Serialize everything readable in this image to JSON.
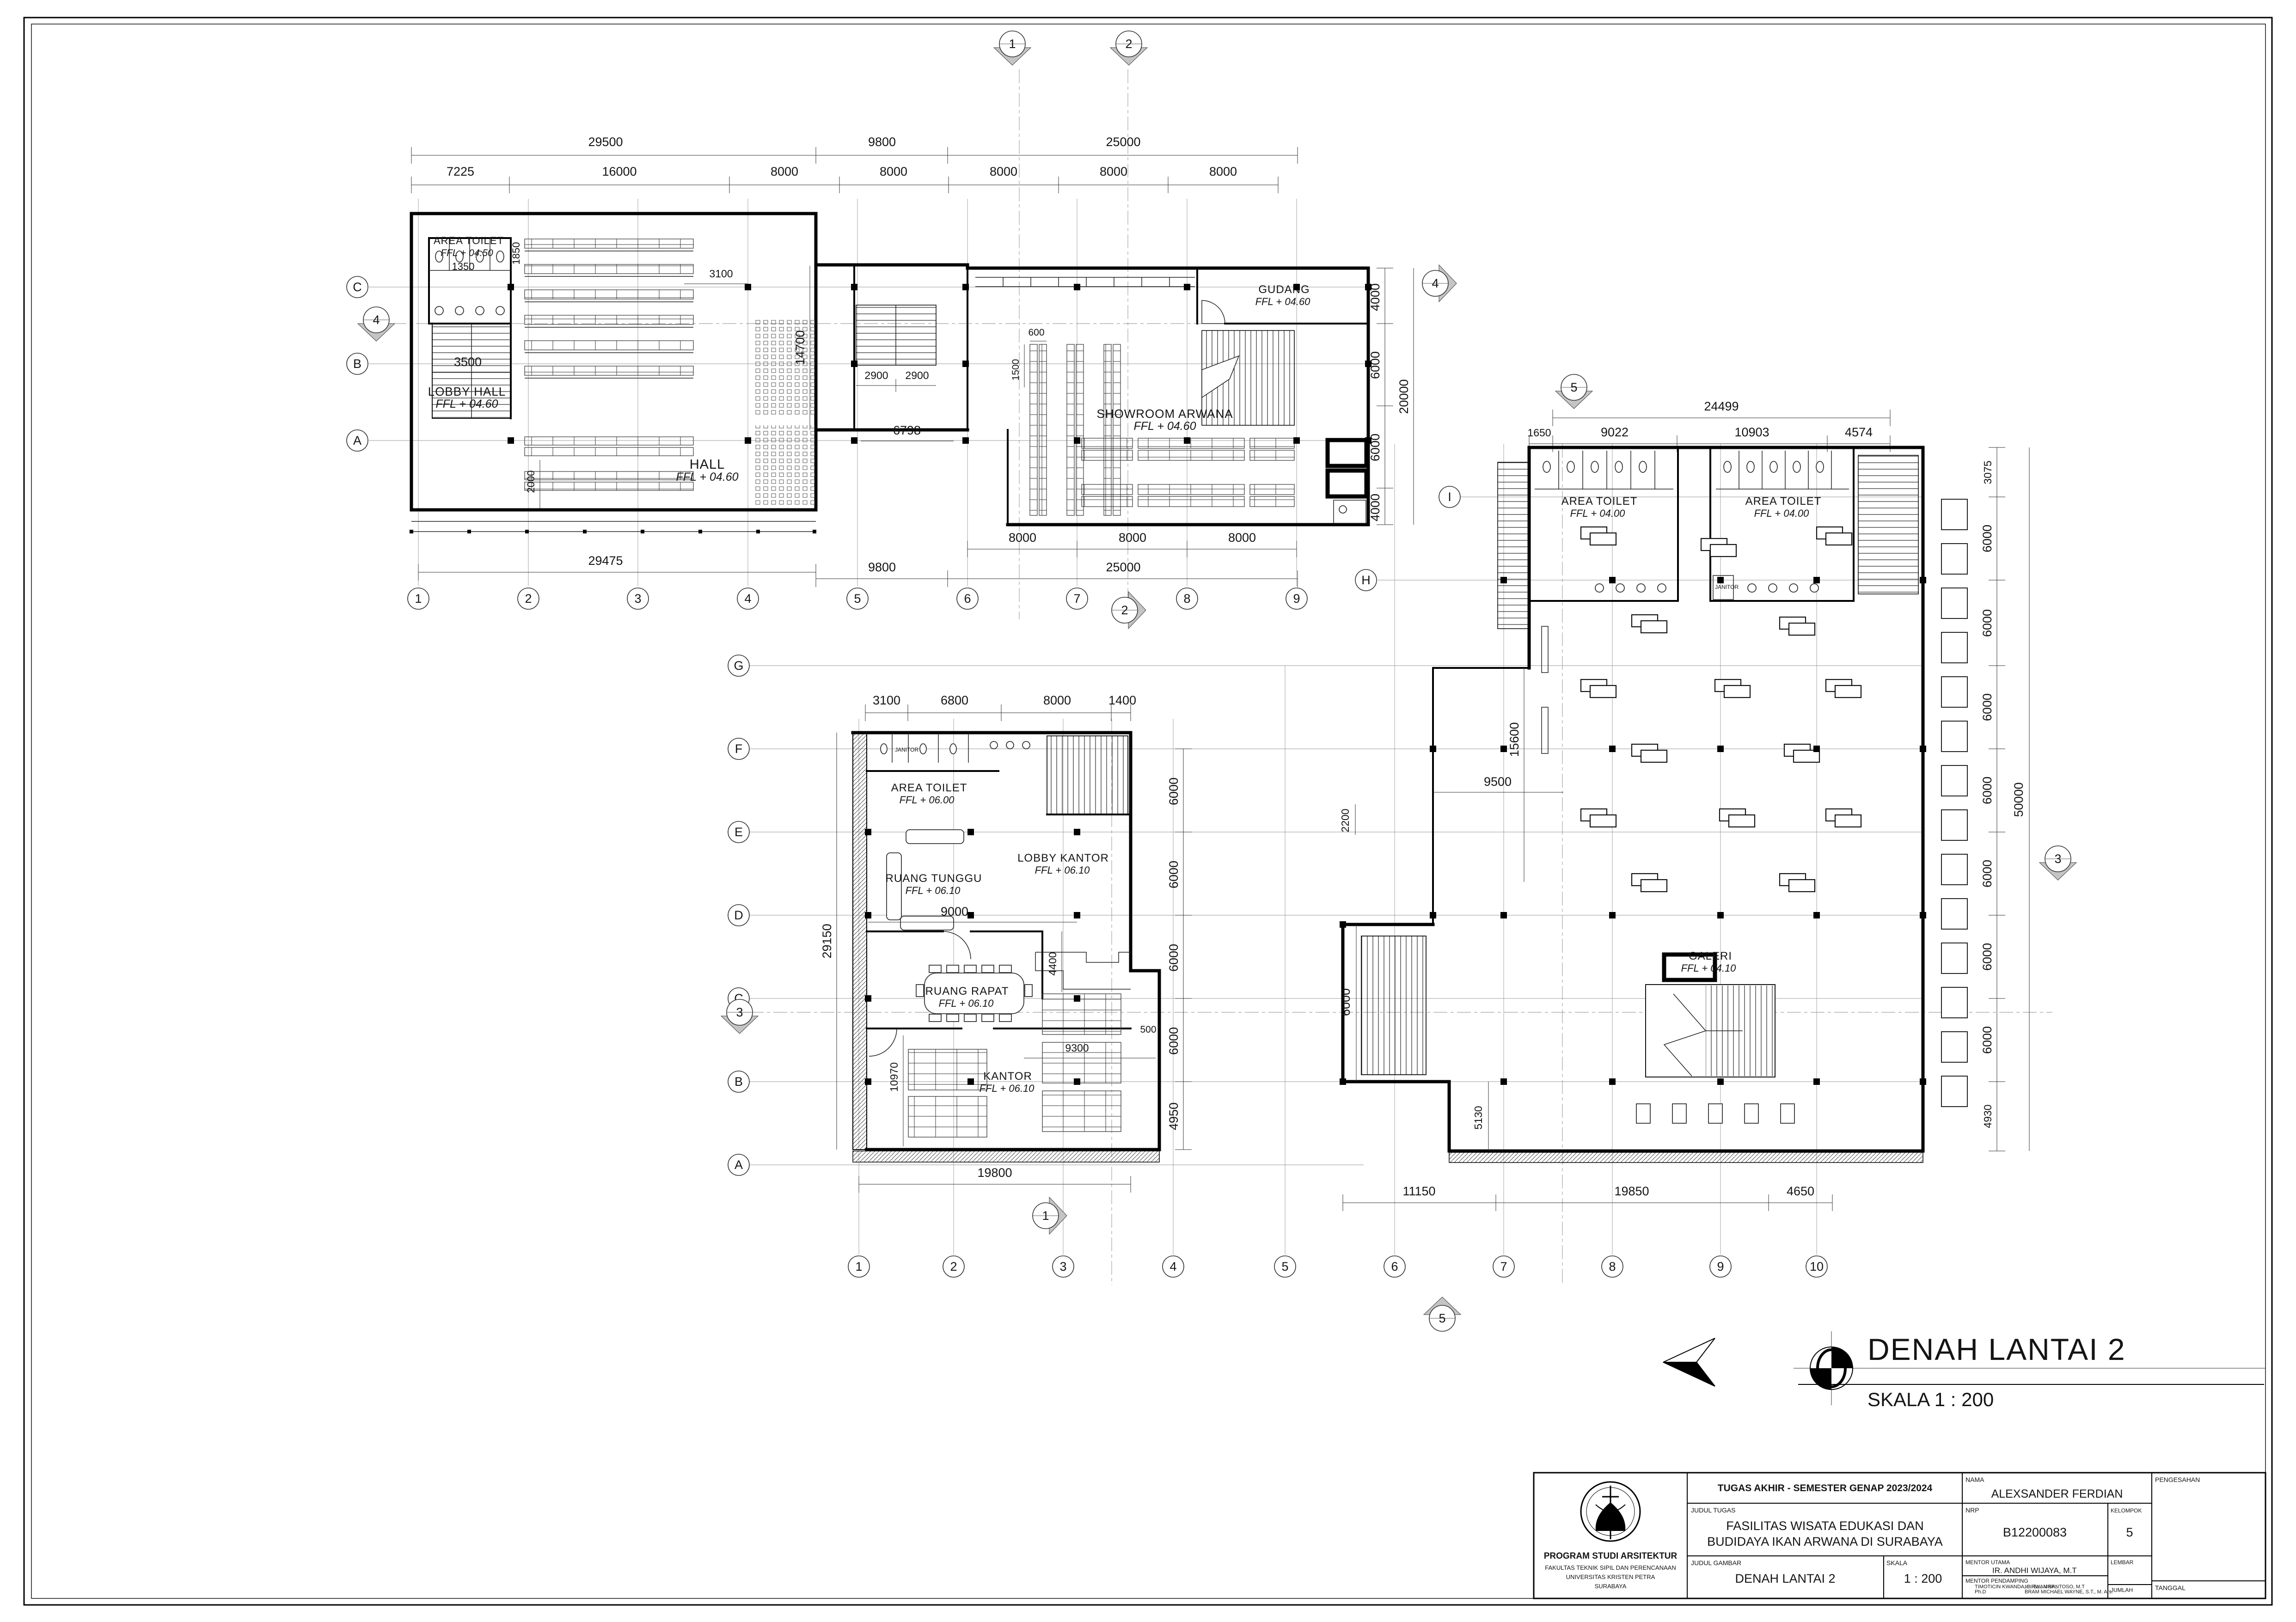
{
  "title": {
    "text": "DENAH LANTAI 2",
    "scale": "SKALA 1 : 200"
  },
  "rooms": {
    "hall": {
      "toilet": [
        "AREA TOILET",
        "FFL + 04.50"
      ],
      "lobby": [
        "LOBBY HALL",
        "FFL + 04.60"
      ],
      "hall": [
        "HALL",
        "FFL + 04.60"
      ]
    },
    "showroom": {
      "gudang": [
        "GUDANG",
        "FFL + 04.60"
      ],
      "showroom": [
        "SHOWROOM ARWANA",
        "FFL + 04.60"
      ]
    },
    "office": {
      "toilet": [
        "AREA TOILET",
        "FFL + 06.00"
      ],
      "janitor": "JANITOR",
      "tunggu": [
        "RUANG TUNGGU",
        "FFL + 06.10"
      ],
      "lobby": [
        "LOBBY KANTOR",
        "FFL + 06.10"
      ],
      "rapat": [
        "RUANG RAPAT",
        "FFL + 06.10"
      ],
      "kantor": [
        "KANTOR",
        "FFL + 06.10"
      ]
    },
    "gallery": {
      "toilet1": [
        "AREA TOILET",
        "FFL + 04.00"
      ],
      "toilet2": [
        "AREA TOILET",
        "FFL + 04.00"
      ],
      "janitor": "JANITOR",
      "galeri": [
        "GALERI",
        "FFL + 04.10"
      ]
    }
  },
  "dims": {
    "top": [
      "29500",
      "9800",
      "25000",
      "7225",
      "16000",
      "8000",
      "8000",
      "8000",
      "8000",
      "8000"
    ],
    "hall": [
      "1850",
      "1350",
      "3500",
      "3100",
      "2000",
      "14700",
      "29475"
    ],
    "link": [
      "2900",
      "2900",
      "6798"
    ],
    "showroom": [
      "600",
      "1500",
      "4000",
      "6000",
      "6000",
      "4000",
      "20000",
      "8000",
      "8000",
      "8000",
      "9800",
      "25000"
    ],
    "office_top": [
      "3100",
      "6800",
      "8000",
      "1400"
    ],
    "office": [
      "9000",
      "4400",
      "9300",
      "500",
      "10970",
      "29150",
      "4950",
      "19800",
      "6000",
      "6000",
      "6000",
      "6000"
    ],
    "gallery_top": [
      "24499",
      "1650",
      "9022",
      "10903",
      "4574"
    ],
    "gallery_left": [
      "15600",
      "9500",
      "2200",
      "6000",
      "5130",
      "11150",
      "19850",
      "4650"
    ],
    "gallery_right": [
      "3075",
      "6000",
      "6000",
      "6000",
      "6000",
      "6000",
      "6000",
      "6000",
      "4930",
      "50000"
    ]
  },
  "grid": {
    "top_cols": [
      "1",
      "2",
      "3",
      "4",
      "5",
      "6",
      "7",
      "8",
      "9"
    ],
    "bottom_cols": [
      "1",
      "2",
      "3",
      "4",
      "5",
      "6",
      "7",
      "8",
      "9",
      "10"
    ],
    "hall_rows": [
      "C",
      "B",
      "A"
    ],
    "office_rows": [
      "G",
      "F",
      "E",
      "D",
      "C",
      "B",
      "A"
    ],
    "gallery_rows": [
      "I",
      "H"
    ]
  },
  "markers": [
    "1",
    "2",
    "4",
    "4",
    "5",
    "2",
    "1",
    "5",
    "3",
    "3"
  ],
  "title_block": {
    "header": "TUGAS AKHIR - SEMESTER GENAP 2023/2024",
    "judul_tugas_label": "JUDUL TUGAS",
    "judul_tugas_1": "FASILITAS WISATA EDUKASI DAN",
    "judul_tugas_2": "BUDIDAYA IKAN ARWANA DI SURABAYA",
    "judul_gambar_label": "JUDUL GAMBAR",
    "judul_gambar": "DENAH LANTAI 2",
    "skala_label": "SKALA",
    "skala": "1 : 200",
    "nama_label": "NAMA",
    "nama": "ALEXSANDER FERDIAN",
    "nrp_label": "NRP",
    "nrp": "B12200083",
    "kelompok_label": "KELOMPOK",
    "kelompok": "5",
    "mentor_utama_label": "MENTOR UTAMA",
    "mentor_utama": "IR.    ANDHI WIJAYA, M.T",
    "mentor_pendamping_label": "MENTOR PENDAMPING",
    "mentor_pendamping": [
      "TIMOTICIN KWANDA, B. Sc., MRP.,",
      "Ph.D",
      "Ir. IRWAN SANTOSO, M.T",
      "BRAM MICHAEL WAYNE, S.T., M. Ars."
    ],
    "lembar_label": "LEMBAR",
    "jumlah_label": "JUMLAH",
    "pengesahan_label": "PENGESAHAN",
    "tanggal_label": "TANGGAL",
    "prodi": "PROGRAM STUDI ARSITEKTUR",
    "fakultas": "FAKULTAS TEKNIK SIPIL DAN PERENCANAAN",
    "univ": "UNIVERSITAS KRISTEN PETRA",
    "kota": "SURABAYA"
  }
}
